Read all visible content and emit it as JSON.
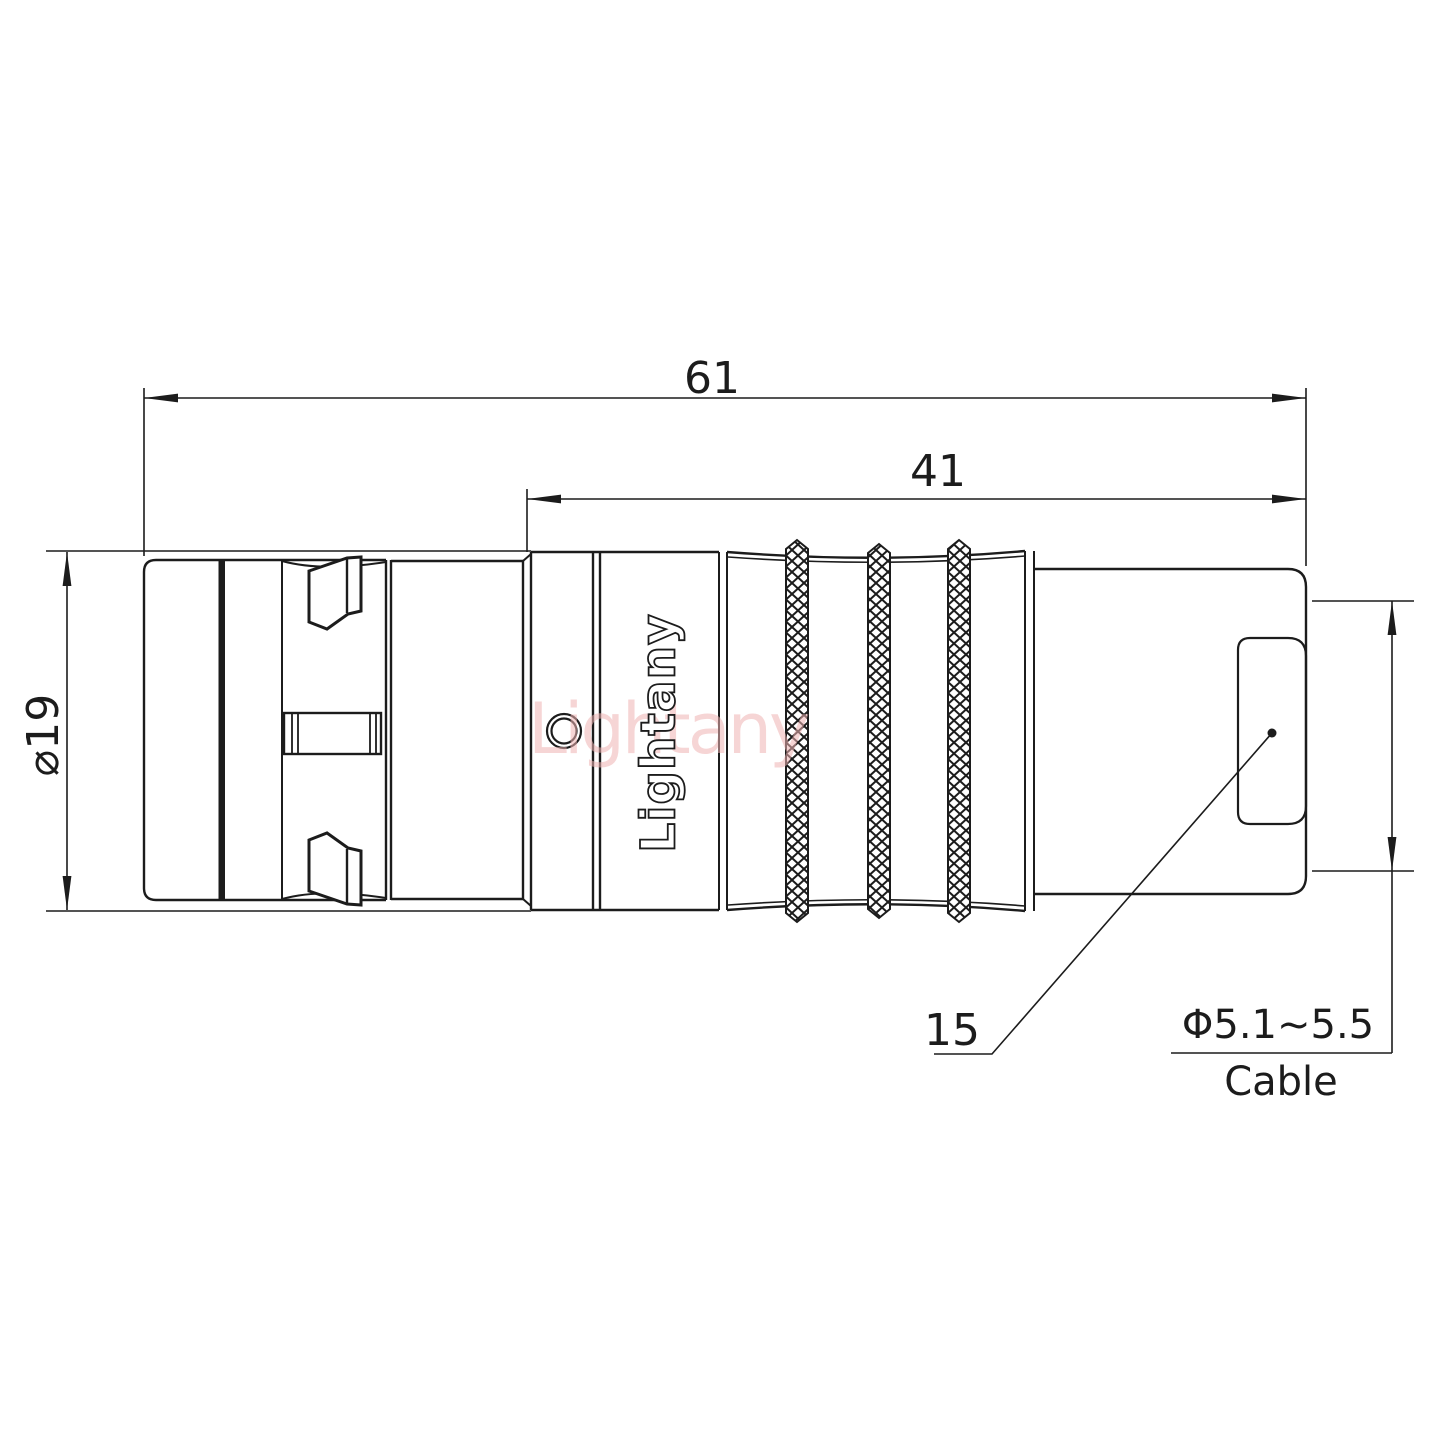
{
  "meta": {
    "background_color": "#ffffff",
    "line_color": "#1c1c1c",
    "watermark_color": "#f0b4b4",
    "drawing_type": "connector technical drawing"
  },
  "watermark": {
    "text": "Lightany"
  },
  "logo": {
    "text": "Lightany"
  },
  "dimensions": {
    "overall_length": {
      "value": "61"
    },
    "rear_length": {
      "value": "41"
    },
    "body_diameter": {
      "value": "⌀19"
    },
    "callout_size": {
      "value": "15"
    },
    "cable_diameter": {
      "value": "Φ5.1~5.5"
    },
    "cable_word": {
      "value": "Cable"
    }
  }
}
